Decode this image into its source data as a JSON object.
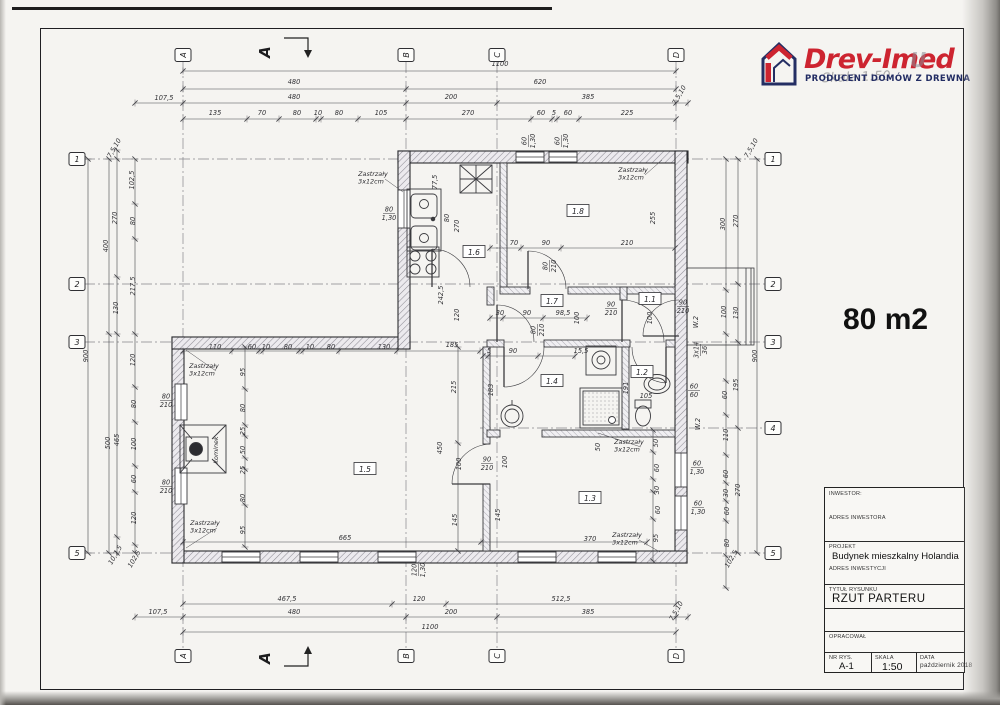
{
  "page": {
    "area_label": "80 m2"
  },
  "logo": {
    "brand": "Drev-Imed",
    "ghost": "U",
    "tagline": "PRODUCENT DOMÓW Z DREWNA",
    "watermark": "Skala 1:50",
    "brand_color": "#cd2430",
    "tagline_color": "#222c63"
  },
  "title_block": {
    "inwestor_label": "INWESTOR:",
    "adres_inwestora_label": "ADRES INWESTORA",
    "projekt_label": "PROJEKT",
    "projekt_value": "Budynek mieszkalny Holandia",
    "adres_inwestycji_label": "ADRES INWESTYCJI",
    "tytul_label": "TYTUŁ RYSUNKU",
    "tytul_value": "RZUT PARTERU",
    "opracowal_label": "OPRACOWAŁ",
    "nr_rys_label": "NR RYS.",
    "nr_rys_value": "A-1",
    "skala_label": "SKALA",
    "skala_value": "1:50",
    "data_label": "DATA",
    "data_value": "październik 2018"
  },
  "plan": {
    "section_label": "A",
    "grid_markers": {
      "top": [
        {
          "t": "A",
          "x": 183,
          "y": 55
        },
        {
          "t": "B",
          "x": 406,
          "y": 55
        },
        {
          "t": "C",
          "x": 497,
          "y": 55
        },
        {
          "t": "D",
          "x": 676,
          "y": 55
        }
      ],
      "bottom": [
        {
          "t": "A",
          "x": 183,
          "y": 656
        },
        {
          "t": "B",
          "x": 406,
          "y": 656
        },
        {
          "t": "C",
          "x": 497,
          "y": 656
        },
        {
          "t": "D",
          "x": 676,
          "y": 656
        }
      ],
      "left": [
        {
          "t": "1",
          "x": 77,
          "y": 159
        },
        {
          "t": "2",
          "x": 77,
          "y": 284
        },
        {
          "t": "3",
          "x": 77,
          "y": 342
        },
        {
          "t": "5",
          "x": 77,
          "y": 553
        }
      ],
      "right": [
        {
          "t": "1",
          "x": 773,
          "y": 159
        },
        {
          "t": "2",
          "x": 773,
          "y": 284
        },
        {
          "t": "3",
          "x": 773,
          "y": 342
        },
        {
          "t": "4",
          "x": 773,
          "y": 428
        },
        {
          "t": "5",
          "x": 773,
          "y": 553
        }
      ]
    },
    "room_labels": [
      {
        "t": "1.1",
        "x": 650,
        "y": 300
      },
      {
        "t": "1.2",
        "x": 642,
        "y": 373
      },
      {
        "t": "1.3",
        "x": 590,
        "y": 499
      },
      {
        "t": "1.4",
        "x": 552,
        "y": 382
      },
      {
        "t": "1.5",
        "x": 365,
        "y": 470
      },
      {
        "t": "1.6",
        "x": 474,
        "y": 253
      },
      {
        "t": "1.7",
        "x": 552,
        "y": 302
      },
      {
        "t": "1.8",
        "x": 578,
        "y": 212
      }
    ],
    "annotations": [
      {
        "l1": "Zastrzały",
        "l2": "3x12cm",
        "x": 373,
        "y": 176,
        "lx": 403,
        "ly": 192
      },
      {
        "l1": "Zastrzały",
        "l2": "3x12cm",
        "x": 633,
        "y": 172,
        "lx": 662,
        "ly": 160
      },
      {
        "l1": "Zastrzały",
        "l2": "3x12cm",
        "x": 204,
        "y": 368,
        "lx": 186,
        "ly": 350
      },
      {
        "l1": "Zastrzały",
        "l2": "3x12cm",
        "x": 205,
        "y": 525,
        "lx": 186,
        "ly": 548
      },
      {
        "l1": "Zastrzały",
        "l2": "3x12cm",
        "x": 629,
        "y": 444,
        "lx": 598,
        "ly": 433
      },
      {
        "l1": "Zastrzały",
        "l2": "3x12cm",
        "x": 627,
        "y": 537,
        "lx": 660,
        "ly": 552
      }
    ],
    "fixture_labels": [
      {
        "t": "kominek",
        "x": 218,
        "y": 450,
        "r": -90
      }
    ],
    "dims": [
      {
        "t": "1100",
        "x": 500,
        "y": 66
      },
      {
        "t": "480",
        "x": 294,
        "y": 84
      },
      {
        "t": "620",
        "x": 540,
        "y": 84
      },
      {
        "t": "107,5",
        "x": 164,
        "y": 100
      },
      {
        "t": "480",
        "x": 294,
        "y": 99
      },
      {
        "t": "200",
        "x": 451,
        "y": 99
      },
      {
        "t": "385",
        "x": 588,
        "y": 99
      },
      {
        "t": "7,5,10",
        "x": 681,
        "y": 96,
        "r": -60
      },
      {
        "t": "135",
        "x": 215,
        "y": 115
      },
      {
        "t": "70",
        "x": 262,
        "y": 115
      },
      {
        "t": "80",
        "x": 297,
        "y": 115
      },
      {
        "t": "10",
        "x": 318,
        "y": 115
      },
      {
        "t": "80",
        "x": 339,
        "y": 115
      },
      {
        "t": "105",
        "x": 381,
        "y": 115
      },
      {
        "t": "270",
        "x": 468,
        "y": 115
      },
      {
        "t": "60",
        "x": 541,
        "y": 115
      },
      {
        "t": "5",
        "x": 554,
        "y": 115
      },
      {
        "t": "60",
        "x": 568,
        "y": 115
      },
      {
        "t": "225",
        "x": 627,
        "y": 115
      },
      {
        "t": "467,5",
        "x": 287,
        "y": 601
      },
      {
        "t": "120",
        "x": 419,
        "y": 601
      },
      {
        "t": "512,5",
        "x": 561,
        "y": 601
      },
      {
        "t": "107,5",
        "x": 158,
        "y": 614
      },
      {
        "t": "480",
        "x": 294,
        "y": 614
      },
      {
        "t": "200",
        "x": 451,
        "y": 614
      },
      {
        "t": "385",
        "x": 588,
        "y": 614
      },
      {
        "t": "7,5,10",
        "x": 678,
        "y": 612,
        "r": -60
      },
      {
        "t": "1100",
        "x": 430,
        "y": 629
      },
      {
        "t": "900",
        "x": 88,
        "y": 356,
        "r": -90
      },
      {
        "t": "400",
        "x": 108,
        "y": 246,
        "r": -90
      },
      {
        "t": "500",
        "x": 110,
        "y": 443,
        "r": -90
      },
      {
        "t": "7,5,10",
        "x": 116,
        "y": 149,
        "r": -60
      },
      {
        "t": "270",
        "x": 117,
        "y": 218,
        "r": -90
      },
      {
        "t": "130",
        "x": 118,
        "y": 308,
        "r": -90
      },
      {
        "t": "465",
        "x": 119,
        "y": 440,
        "r": -90
      },
      {
        "t": "10,2,5",
        "x": 117,
        "y": 556,
        "r": -60
      },
      {
        "t": "102,5",
        "x": 134,
        "y": 180,
        "r": -90
      },
      {
        "t": "80",
        "x": 135,
        "y": 221,
        "r": -90
      },
      {
        "t": "217,5",
        "x": 135,
        "y": 286,
        "r": -90
      },
      {
        "t": "120",
        "x": 135,
        "y": 360,
        "r": -90
      },
      {
        "t": "80",
        "x": 136,
        "y": 404,
        "r": -90
      },
      {
        "t": "100",
        "x": 136,
        "y": 444,
        "r": -90
      },
      {
        "t": "60",
        "x": 136,
        "y": 479,
        "r": -90
      },
      {
        "t": "120",
        "x": 136,
        "y": 518,
        "r": -90
      },
      {
        "t": "102,5",
        "x": 136,
        "y": 560,
        "r": -60
      },
      {
        "t": "900",
        "x": 757,
        "y": 356,
        "r": -90
      },
      {
        "t": "270",
        "x": 738,
        "y": 221,
        "r": -90
      },
      {
        "t": "130",
        "x": 738,
        "y": 313,
        "r": -90
      },
      {
        "t": "195",
        "x": 738,
        "y": 385,
        "r": -90
      },
      {
        "t": "270",
        "x": 740,
        "y": 490,
        "r": -90
      },
      {
        "t": "300",
        "x": 725,
        "y": 224,
        "r": -90
      },
      {
        "t": "100",
        "x": 726,
        "y": 312,
        "r": -90
      },
      {
        "t": "60",
        "x": 727,
        "y": 395,
        "r": -90
      },
      {
        "t": "110",
        "x": 728,
        "y": 435,
        "r": -90
      },
      {
        "t": "60",
        "x": 728,
        "y": 474,
        "r": -90
      },
      {
        "t": "30",
        "x": 728,
        "y": 493,
        "r": -90
      },
      {
        "t": "60",
        "x": 729,
        "y": 511,
        "r": -90
      },
      {
        "t": "80",
        "x": 729,
        "y": 543,
        "r": -90
      },
      {
        "t": "102,5",
        "x": 733,
        "y": 560,
        "r": -60
      },
      {
        "t": "7,5,10",
        "x": 753,
        "y": 149,
        "r": -60
      },
      {
        "t": "3x14",
        "t2": "36",
        "x": 700,
        "y": 350,
        "r": -90
      },
      {
        "t": "W.2",
        "x": 698,
        "y": 322,
        "r": -90
      },
      {
        "t": "W.2",
        "x": 700,
        "y": 424,
        "r": -90
      },
      {
        "t": "77,5",
        "x": 437,
        "y": 182,
        "r": -90
      },
      {
        "t": "80",
        "x": 449,
        "y": 218,
        "r": -90
      },
      {
        "t": "270",
        "x": 459,
        "y": 226,
        "r": -90
      },
      {
        "t": "242,5",
        "x": 443,
        "y": 295,
        "r": -90
      },
      {
        "t": "120",
        "x": 459,
        "y": 315,
        "r": -90
      },
      {
        "t": "80",
        "t2": "1,30",
        "x": 389,
        "y": 213
      },
      {
        "t": "70",
        "x": 514,
        "y": 245
      },
      {
        "t": "90",
        "x": 546,
        "y": 245
      },
      {
        "t": "210",
        "x": 627,
        "y": 245
      },
      {
        "t": "255",
        "x": 655,
        "y": 218,
        "r": -90
      },
      {
        "t": "80",
        "t2": "210",
        "x": 549,
        "y": 266,
        "r": -90
      },
      {
        "t": "30",
        "x": 500,
        "y": 315
      },
      {
        "t": "90",
        "x": 527,
        "y": 315
      },
      {
        "t": "98,5",
        "x": 563,
        "y": 315
      },
      {
        "t": "100",
        "x": 579,
        "y": 318,
        "r": -90
      },
      {
        "t": "90",
        "t2": "210",
        "x": 611,
        "y": 308
      },
      {
        "t": "100",
        "x": 652,
        "y": 318,
        "r": -90
      },
      {
        "t": "90",
        "t2": "210",
        "x": 683,
        "y": 306
      },
      {
        "t": "80",
        "t2": "210",
        "x": 537,
        "y": 330,
        "r": -90
      },
      {
        "t": "5",
        "x": 489,
        "y": 353
      },
      {
        "t": "90",
        "x": 513,
        "y": 353
      },
      {
        "t": "15,5",
        "x": 581,
        "y": 353
      },
      {
        "t": "183",
        "x": 493,
        "y": 390,
        "r": -90
      },
      {
        "t": "191",
        "x": 628,
        "y": 388,
        "r": -90
      },
      {
        "t": "105",
        "x": 646,
        "y": 398
      },
      {
        "t": "50",
        "x": 600,
        "y": 447,
        "r": -90
      },
      {
        "t": "60",
        "t2": "60",
        "x": 694,
        "y": 390
      },
      {
        "t": "370",
        "x": 590,
        "y": 541
      },
      {
        "t": "90",
        "t2": "210",
        "x": 487,
        "y": 463
      },
      {
        "t": "100",
        "x": 507,
        "y": 462,
        "r": -90
      },
      {
        "t": "145",
        "x": 500,
        "y": 515,
        "r": -90
      },
      {
        "t": "50",
        "x": 658,
        "y": 443,
        "r": -90
      },
      {
        "t": "60",
        "x": 659,
        "y": 468,
        "r": -90
      },
      {
        "t": "30",
        "x": 659,
        "y": 490,
        "r": -90
      },
      {
        "t": "60",
        "x": 660,
        "y": 510,
        "r": -90
      },
      {
        "t": "95",
        "x": 658,
        "y": 538,
        "r": -90
      },
      {
        "t": "60",
        "t2": "1,30",
        "x": 697,
        "y": 467
      },
      {
        "t": "60",
        "t2": "1,30",
        "x": 698,
        "y": 507
      },
      {
        "t": "110",
        "x": 215,
        "y": 349
      },
      {
        "t": "60",
        "x": 252,
        "y": 349
      },
      {
        "t": "10",
        "x": 266,
        "y": 349
      },
      {
        "t": "80",
        "x": 288,
        "y": 349
      },
      {
        "t": "10",
        "x": 310,
        "y": 349
      },
      {
        "t": "80",
        "x": 331,
        "y": 349
      },
      {
        "t": "130",
        "x": 384,
        "y": 349
      },
      {
        "t": "185",
        "x": 452,
        "y": 347
      },
      {
        "t": "95",
        "x": 245,
        "y": 372,
        "r": -90
      },
      {
        "t": "80",
        "x": 245,
        "y": 408,
        "r": -90
      },
      {
        "t": "25",
        "x": 245,
        "y": 431,
        "r": -90
      },
      {
        "t": "50",
        "x": 245,
        "y": 450,
        "r": -90
      },
      {
        "t": "25",
        "x": 245,
        "y": 470,
        "r": -90
      },
      {
        "t": "80",
        "x": 245,
        "y": 498,
        "r": -90
      },
      {
        "t": "95",
        "x": 245,
        "y": 530,
        "r": -90
      },
      {
        "t": "215",
        "x": 456,
        "y": 387,
        "r": -90
      },
      {
        "t": "450",
        "x": 442,
        "y": 448,
        "r": -90
      },
      {
        "t": "100",
        "x": 461,
        "y": 464,
        "r": -90
      },
      {
        "t": "145",
        "x": 457,
        "y": 520,
        "r": -90
      },
      {
        "t": "665",
        "x": 345,
        "y": 540
      },
      {
        "t": "80",
        "t2": "210",
        "x": 166,
        "y": 400
      },
      {
        "t": "80",
        "t2": "210",
        "x": 166,
        "y": 486
      },
      {
        "t": "120",
        "t2": "1,30",
        "x": 418,
        "y": 570,
        "r": -90
      },
      {
        "t": "60",
        "t2": "1,30",
        "x": 528,
        "y": 141,
        "r": -90
      },
      {
        "t": "60",
        "t2": "1,30",
        "x": 561,
        "y": 141,
        "r": -90
      }
    ]
  }
}
